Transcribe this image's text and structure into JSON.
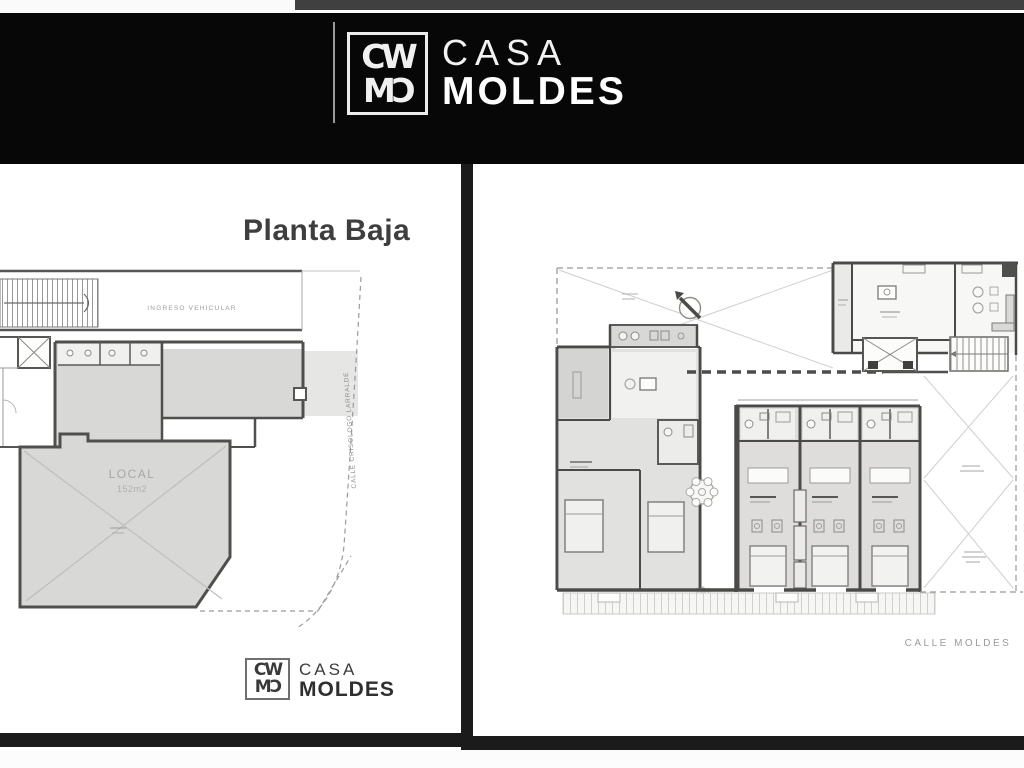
{
  "brand": {
    "monogram_top": "CW",
    "monogram_bottom": "MƆ",
    "name_line1": "CASA",
    "name_line2": "MOLDES"
  },
  "left_panel": {
    "title": "Planta Baja",
    "labels": {
      "ramp": "INGRESO VEHICULAR",
      "local_name": "LOCAL",
      "local_area": "152m2",
      "street": "CALLE CRISOLOGO LARRALDE"
    }
  },
  "right_panel": {
    "street": "CALLE MOLDES"
  },
  "colors": {
    "header_bg": "#070707",
    "panel_bg": "#ffffff",
    "frame": "#1b1b1b",
    "wall": "#4f4f4d",
    "room_fill": "#d8d8d6",
    "title_text": "#3e3e3e",
    "plan_text": "#9b9b99"
  }
}
